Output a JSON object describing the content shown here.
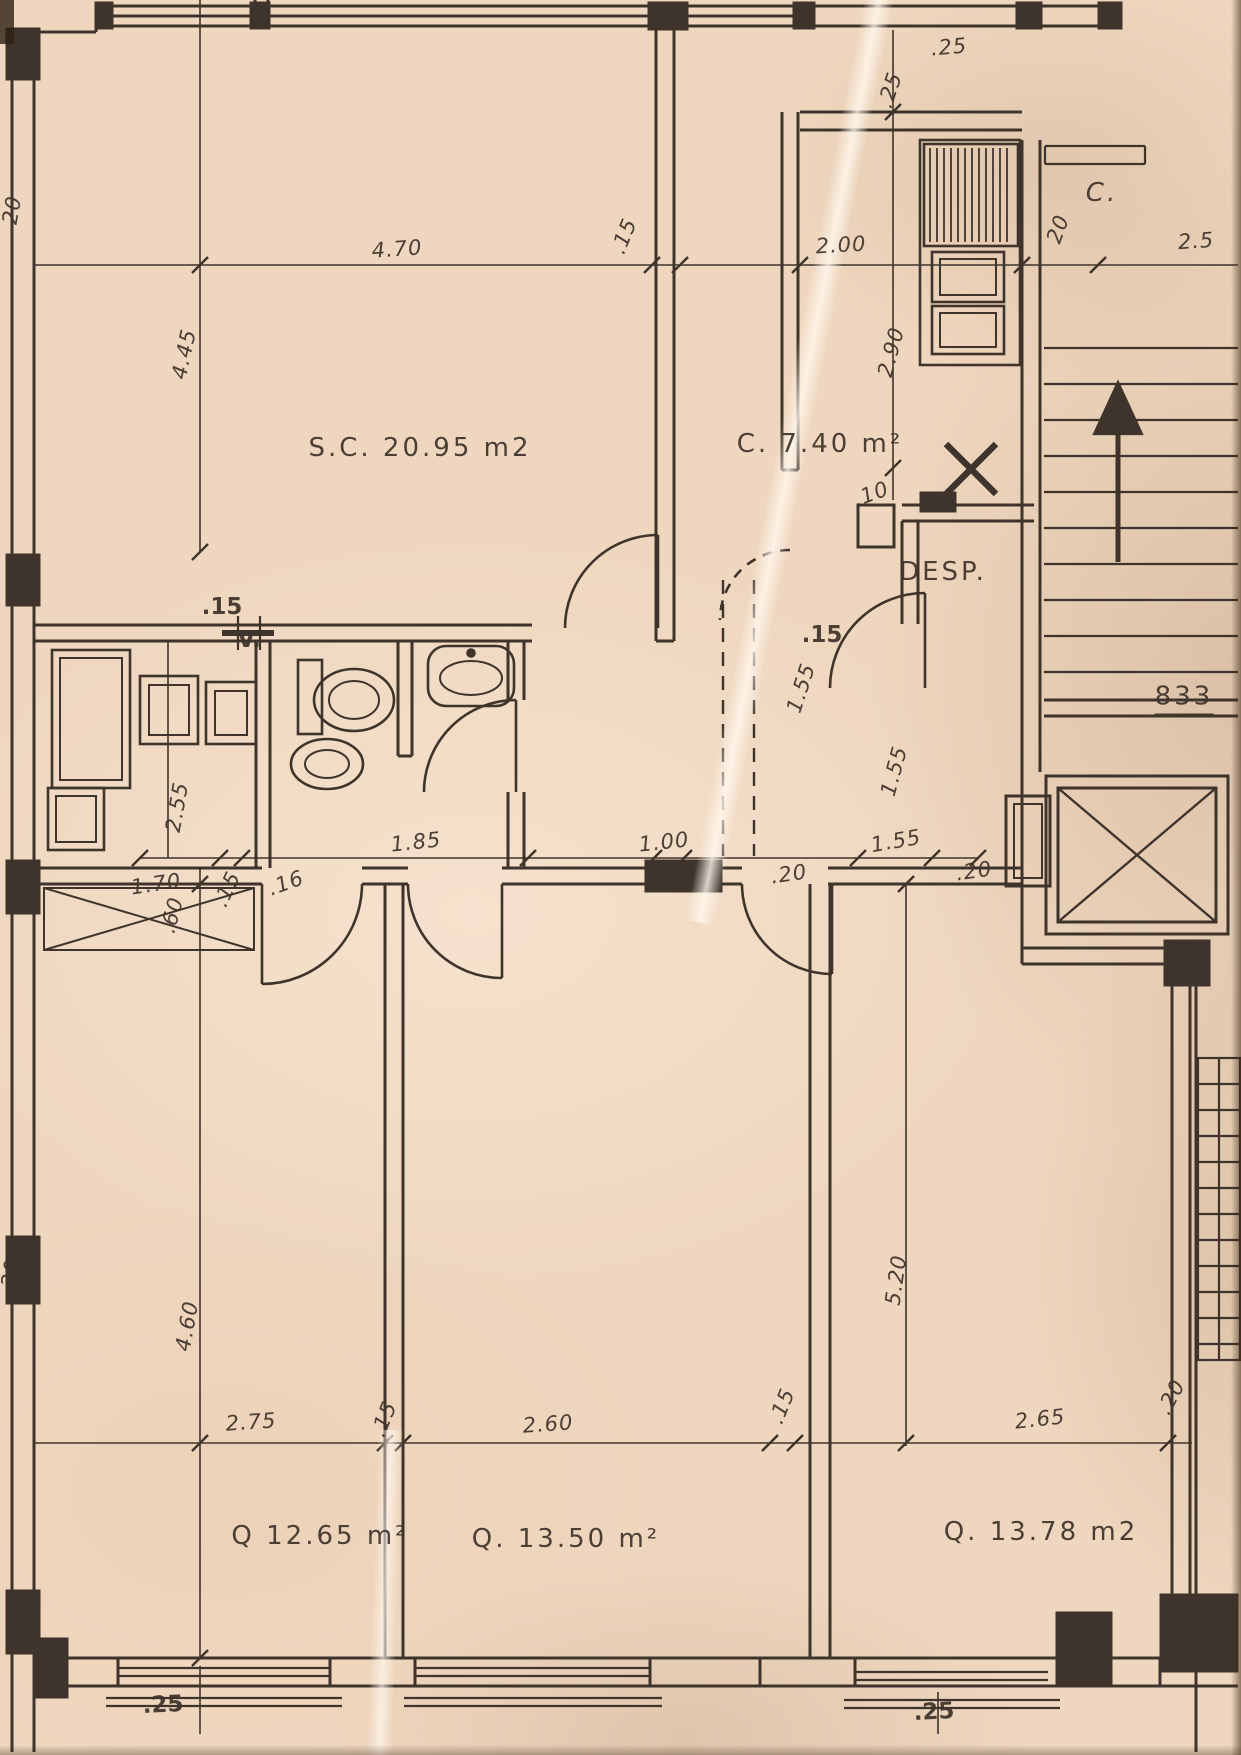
{
  "sheet": {
    "kind": "apartment floor plan (scanned blueprint)"
  },
  "colors": {
    "paper": "#efd7bf",
    "ink": "#3f342b",
    "smudge": "#a88a6c"
  },
  "rooms": [
    {
      "name": "living",
      "label": "S.C. 20.95 m2",
      "x": 420,
      "y": 448
    },
    {
      "name": "hall",
      "label": "C. 7.40 m²",
      "x": 820,
      "y": 444
    },
    {
      "name": "pantry",
      "label": "DESP.",
      "x": 943,
      "y": 572
    },
    {
      "name": "stair-landing",
      "label": "C.",
      "x": 1102,
      "y": 193
    },
    {
      "name": "bedroom-1",
      "label": "Q 12.65 m²",
      "x": 320,
      "y": 1536
    },
    {
      "name": "bedroom-2",
      "label": "Q. 13.50 m²",
      "x": 566,
      "y": 1539
    },
    {
      "name": "bedroom-3",
      "label": "Q. 13.78 m2",
      "x": 1041,
      "y": 1532
    },
    {
      "name": "level-mark",
      "label": "833",
      "x": 1184,
      "y": 699
    }
  ],
  "dimensions": [
    {
      "label": "4.70",
      "x": 397,
      "y": 249,
      "rot": -4
    },
    {
      "label": ".15",
      "x": 624,
      "y": 236,
      "rot": -68
    },
    {
      "label": "2.00",
      "x": 841,
      "y": 245,
      "rot": -3
    },
    {
      "label": ".25",
      "x": 949,
      "y": 47,
      "rot": -5
    },
    {
      "label": ".25",
      "x": 890,
      "y": 90,
      "rot": -72
    },
    {
      "label": "20",
      "x": 1058,
      "y": 229,
      "rot": -70
    },
    {
      "label": "2.5",
      "x": 1196,
      "y": 241,
      "rot": -4
    },
    {
      "label": "2.90",
      "x": 891,
      "y": 352,
      "rot": -75
    },
    {
      "label": ".10",
      "x": 871,
      "y": 494,
      "rot": -20
    },
    {
      "label": "4.45",
      "x": 184,
      "y": 354,
      "rot": -78
    },
    {
      "label": ".15",
      "x": 222,
      "y": 607,
      "rot": 0,
      "bold": true
    },
    {
      "label": "V.",
      "x": 249,
      "y": 640,
      "rot": 0,
      "bold": true
    },
    {
      "label": "2.55",
      "x": 177,
      "y": 807,
      "rot": -80
    },
    {
      "label": "1.70",
      "x": 156,
      "y": 884,
      "rot": -8
    },
    {
      "label": ".15",
      "x": 227,
      "y": 889,
      "rot": -65
    },
    {
      "label": ".16",
      "x": 286,
      "y": 883,
      "rot": -20
    },
    {
      "label": "1.85",
      "x": 416,
      "y": 842,
      "rot": -6
    },
    {
      "label": "1.00",
      "x": 664,
      "y": 842,
      "rot": -6
    },
    {
      "label": ".20",
      "x": 789,
      "y": 874,
      "rot": -8
    },
    {
      "label": "1.55",
      "x": 896,
      "y": 841,
      "rot": -10
    },
    {
      "label": ".20",
      "x": 974,
      "y": 871,
      "rot": -8
    },
    {
      "label": ".15",
      "x": 822,
      "y": 635,
      "rot": 0,
      "bold": true
    },
    {
      "label": "1.55",
      "x": 801,
      "y": 688,
      "rot": -72
    },
    {
      "label": "1.55",
      "x": 894,
      "y": 771,
      "rot": -75
    },
    {
      "label": ".60",
      "x": 172,
      "y": 915,
      "rot": -75
    },
    {
      "label": "4.60",
      "x": 187,
      "y": 1326,
      "rot": -80
    },
    {
      "label": "5.20",
      "x": 896,
      "y": 1280,
      "rot": -82
    },
    {
      "label": "2.75",
      "x": 251,
      "y": 1422,
      "rot": -4
    },
    {
      "label": ".15",
      "x": 384,
      "y": 1419,
      "rot": -68
    },
    {
      "label": "2.60",
      "x": 548,
      "y": 1424,
      "rot": -4
    },
    {
      "label": ".15",
      "x": 782,
      "y": 1406,
      "rot": -68
    },
    {
      "label": "2.65",
      "x": 1040,
      "y": 1419,
      "rot": -6
    },
    {
      "label": ".20",
      "x": 1171,
      "y": 1397,
      "rot": -62
    },
    {
      "label": ".25",
      "x": 163,
      "y": 1705,
      "rot": -3,
      "bold": true
    },
    {
      "label": ".25",
      "x": 934,
      "y": 1712,
      "rot": -3,
      "bold": true
    },
    {
      "label": "20",
      "x": 12,
      "y": 210,
      "rot": -80
    },
    {
      "label": ".20",
      "x": 10,
      "y": 1277,
      "rot": -80
    }
  ]
}
